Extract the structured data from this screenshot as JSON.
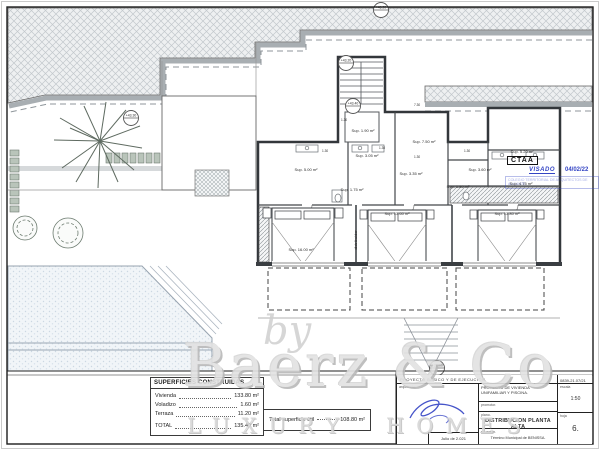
{
  "watermark": {
    "by": "by",
    "brand": "Baerz & Co",
    "tagline": "LUXURY HOMES"
  },
  "stamp": {
    "org": "CTAA",
    "visado": "VISADO",
    "date": "04/02/22",
    "college": "COLEGIO TERRITORIAL DE ARQUITECTOS DE ALICANTE"
  },
  "areas_table": {
    "title": "SUPERFICIES CONSTRUIDAS",
    "rows": [
      {
        "label": "Vivienda",
        "value": "133.80 m²"
      },
      {
        "label": "Voladizo",
        "value": "1.60 m²"
      },
      {
        "label": "Terraza",
        "value": "11.20 m²"
      },
      {
        "label": "TOTAL",
        "value": "135.40 m²"
      }
    ]
  },
  "useful_area": {
    "label": "Total superficie útil",
    "value": "108.80 m²"
  },
  "title_block": {
    "project": "PROYECTO BÁSICO Y DE EJECUCIÓN.",
    "code": "0839-21.07/21",
    "architect_label": "arquitecto.",
    "date": "Julio de 2.021",
    "description": "PROYECTO DE VIVIENDA UNIFAMILIAR Y PISCINA.",
    "promotor_label": "promotor.",
    "plano_label": "plano.",
    "plano": "DISTRIBUCION PLANTA ALTA",
    "situacion_label": "situación.",
    "situacion": "Término Municipal de BENISSA.",
    "escala_label": "escala",
    "escala": "1:50",
    "hoja_label": "hoja",
    "hoja": "6."
  },
  "plan": {
    "labels": [
      {
        "text": "Sup. 5.00 m²",
        "x": 306,
        "y": 171
      },
      {
        "text": "Sup. 3.05 m²",
        "x": 367,
        "y": 157
      },
      {
        "text": "Sup. 1.75 m²",
        "x": 352,
        "y": 191
      },
      {
        "text": "Sup. 3.35 m²",
        "x": 411,
        "y": 175
      },
      {
        "text": "Sup. 7.50 m²",
        "x": 424,
        "y": 143
      },
      {
        "text": "Sup. 5.20 m²",
        "x": 522,
        "y": 153
      },
      {
        "text": "Sup. 3.60 m²",
        "x": 480,
        "y": 171
      },
      {
        "text": "Sup. 1.80 m²",
        "x": 458,
        "y": 188
      },
      {
        "text": "Sup. 4.75 m²",
        "x": 521,
        "y": 185
      },
      {
        "text": "Sup. 16.00 m²",
        "x": 301,
        "y": 251
      },
      {
        "text": "Sup. 13.60 m²",
        "x": 397,
        "y": 215
      },
      {
        "text": "Sup. 13.80 m²",
        "x": 507,
        "y": 215
      },
      {
        "text": "Sup. 1.90 m²",
        "x": 363,
        "y": 132
      },
      {
        "text": "distribuidor",
        "x": 357,
        "y": 240
      }
    ],
    "markers": [
      {
        "text": "+46.20",
        "x": 381,
        "y": 10
      },
      {
        "text": "+43.20",
        "x": 346,
        "y": 63
      },
      {
        "text": "+43.40",
        "x": 353,
        "y": 106
      },
      {
        "text": "+43.30",
        "x": 131,
        "y": 118
      },
      {
        "text": "+38.80",
        "x": 437,
        "y": 368
      }
    ],
    "dims": [
      {
        "text": "1.30",
        "x": 322,
        "y": 152
      },
      {
        "text": "1.30",
        "x": 341,
        "y": 121
      },
      {
        "text": "1.30",
        "x": 414,
        "y": 158
      },
      {
        "text": "1.30",
        "x": 464,
        "y": 152
      },
      {
        "text": "7.30",
        "x": 414,
        "y": 106
      },
      {
        "text": "1.30",
        "x": 379,
        "y": 149
      }
    ]
  }
}
